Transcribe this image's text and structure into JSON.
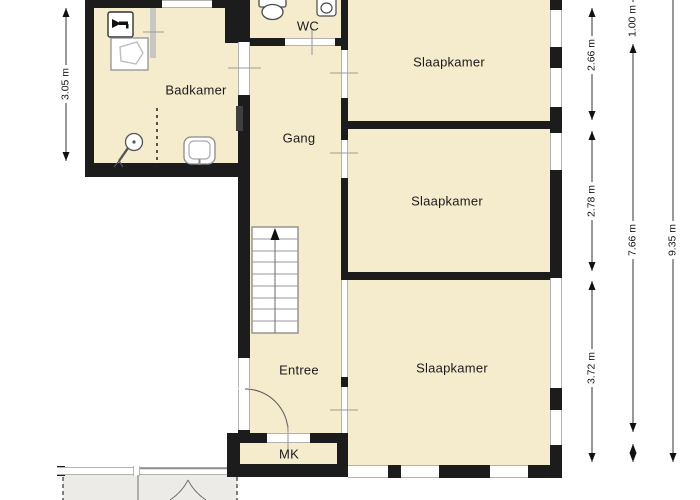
{
  "floorplan": {
    "rooms": [
      {
        "id": "badkamer",
        "label": "Badkamer"
      },
      {
        "id": "wc",
        "label": "WC"
      },
      {
        "id": "gang",
        "label": "Gang"
      },
      {
        "id": "slaapkamer-top",
        "label": "Slaapkamer"
      },
      {
        "id": "slaapkamer-middle",
        "label": "Slaapkamer"
      },
      {
        "id": "slaapkamer-bottom",
        "label": "Slaapkamer"
      },
      {
        "id": "entree",
        "label": "Entree"
      },
      {
        "id": "mk",
        "label": "MK"
      }
    ],
    "dimensions": {
      "left": [
        "3.05 m"
      ],
      "right_col1": [
        "2.66 m",
        "2.78 m",
        "3.72 m"
      ],
      "right_col2": [
        "1.00 m",
        "7.66 m"
      ],
      "right_col3": [
        "9.35 m"
      ]
    },
    "fixtures": [
      "toilet-icon",
      "wc-washbasin-icon",
      "bathroom-washbasin-icon",
      "hand-shower-icon",
      "washing-machine-tap-icon",
      "laundry-basket-icon",
      "stairs-up-arrow-icon",
      "radiator",
      "entree-door-arc",
      "porch-door-arcs"
    ],
    "colors": {
      "floor": "#f5ebcd",
      "wall": "#1c1c1c",
      "opening_frame": "#b5b3ae",
      "dimension_line": "#333333",
      "porch_floor": "#edebe7"
    }
  }
}
